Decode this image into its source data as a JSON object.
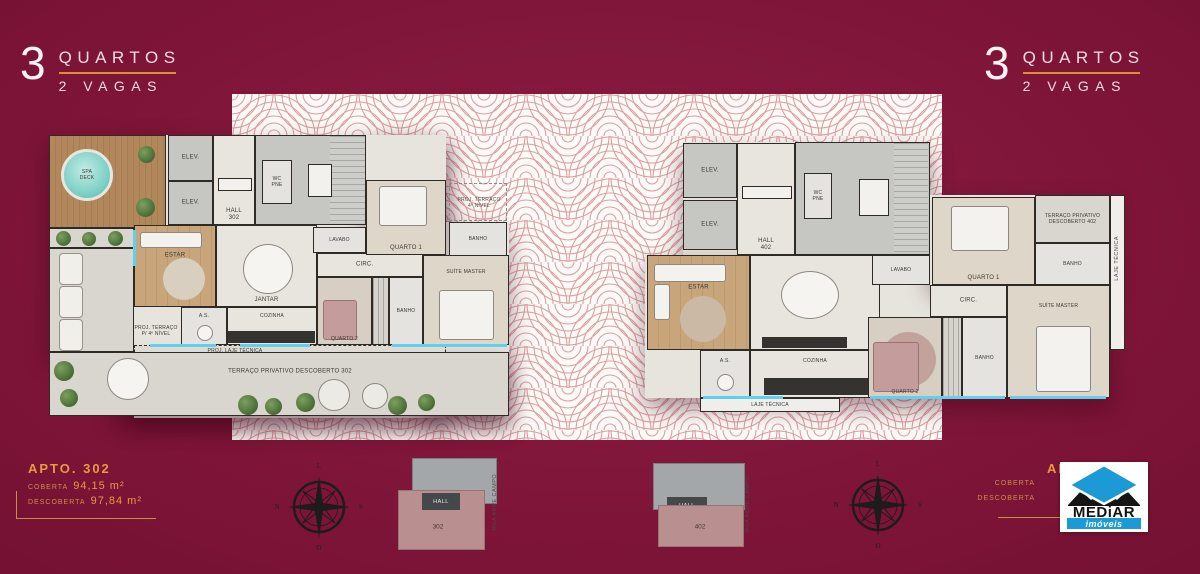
{
  "colors": {
    "background_maroon": "#7A1336",
    "band_white": "#FCFAF8",
    "pattern_red": "#D49090",
    "accent_orange": "#E89B3D",
    "gold_line": "#C9913F",
    "header_pink": "#F2DCE2",
    "logo_blue": "#1B9AD6",
    "keyplan_unit_pink": "#B98F8F",
    "cyan_accent": "#5FD0EF"
  },
  "headers": {
    "left": {
      "number": "3",
      "line1": "QUARTOS",
      "line2": "2 VAGAS"
    },
    "right": {
      "number": "3",
      "line1": "QUARTOS",
      "line2": "2 VAGAS"
    }
  },
  "unit_left": {
    "title": "APTO. 302",
    "areas": [
      {
        "label": "COBERTA",
        "value": "94,15 m²"
      },
      {
        "label": "DESCOBERTA",
        "value": "97,84 m²"
      }
    ]
  },
  "unit_right": {
    "title": "APTO. 402",
    "areas": [
      {
        "label": "COBERTA",
        "value": ""
      },
      {
        "label": "DESCOBERTA",
        "value": ""
      }
    ]
  },
  "logo": {
    "brand": "MEDiAR",
    "tagline": "imóveis"
  },
  "compass": {
    "north": "N",
    "south": "S",
    "east": "L",
    "west": "O"
  },
  "keyplan_left": {
    "hall": "HALL",
    "unit": "302",
    "street": "RUA ABRE CAMPO"
  },
  "keyplan_right": {
    "hall": "HALL",
    "unit": "402",
    "street": "RUA ABRE CAMPO"
  },
  "plan_left": {
    "labels": {
      "spa_line1": "SPA",
      "spa_line2": "DECK",
      "elev": "ELEV.",
      "hall": "HALL",
      "hall_num": "302",
      "wc_line1": "WC",
      "wc_line2": "PNE",
      "lavabo": "LAVABO",
      "estar": "ESTAR",
      "jantar": "JANTAR",
      "cozinha": "COZINHA",
      "as": "A.S.",
      "circ": "CIRC.",
      "quarto1": "QUARTO 1",
      "quarto2": "QUARTO 2",
      "banho": "BANHO",
      "suite": "SUÍTE MASTER",
      "proj_laje": "PROJ. LAJE TÉCNICA",
      "terraco": "TERRAÇO PRIVATIVO DESCOBERTO 302",
      "proj_terraco_l1": "PROJ. TERRAÇO",
      "proj_terraco_l2": "4º NÍVEL",
      "proj_terraco_p_l1": "PROJ. TERRAÇO",
      "proj_terraco_p_l2": "P/ 4º NÍVEL"
    }
  },
  "plan_right": {
    "labels": {
      "elev": "ELEV.",
      "hall": "HALL",
      "hall_num": "402",
      "wc_line1": "WC",
      "wc_line2": "PNE",
      "lavabo": "LAVABO",
      "estar": "ESTAR",
      "jantar": "JANTAR",
      "cozinha": "COZINHA",
      "as": "A.S.",
      "circ": "CIRC.",
      "quarto1": "QUARTO 1",
      "quarto2": "QUARTO 2",
      "banho": "BANHO",
      "suite": "SUÍTE MASTER",
      "laje": "LAJE TÉCNICA",
      "terraco_l1": "TERRAÇO PRIVATIVO",
      "terraco_l2": "DESCOBERTO 402"
    }
  }
}
